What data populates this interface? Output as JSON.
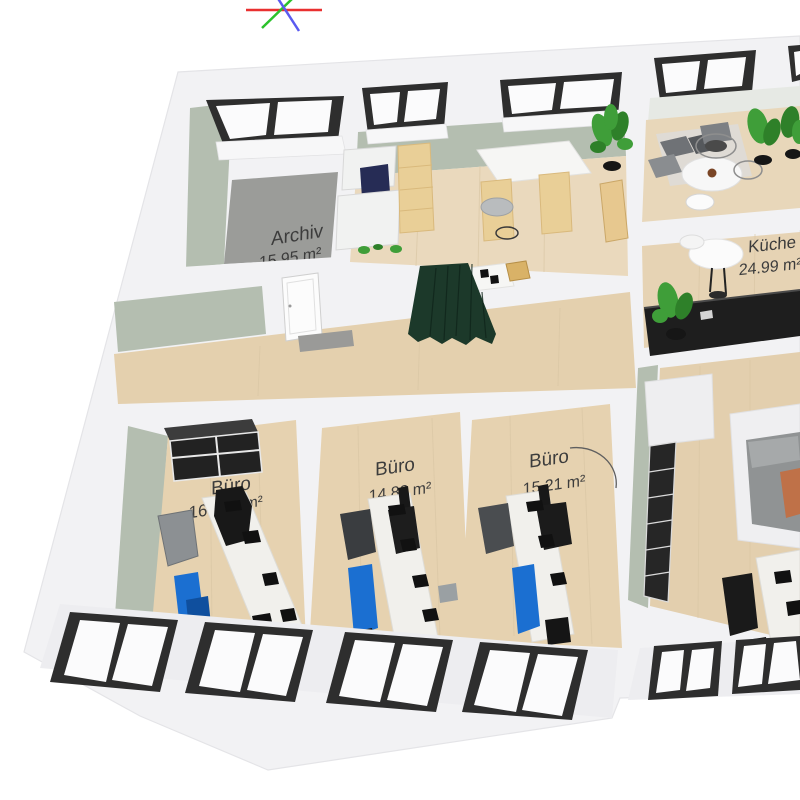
{
  "view": {
    "type": "3D floor plan viewport",
    "background": "#ffffff"
  },
  "axis_gizmo": {
    "axes": [
      {
        "name": "x",
        "color": "#e93030"
      },
      {
        "name": "y",
        "color": "#2cc22c"
      },
      {
        "name": "z",
        "color": "#5a5af0"
      }
    ]
  },
  "rooms": [
    {
      "id": "archiv",
      "name": "Archiv",
      "area": "15.95 m²"
    },
    {
      "id": "kueche",
      "name": "Küche",
      "area": "24.99 m²"
    },
    {
      "id": "buero_1",
      "name": "Büro",
      "area_value": "16",
      "area_unit": "m²"
    },
    {
      "id": "buero_2",
      "name": "Büro",
      "area": "14.82 m²"
    },
    {
      "id": "buero_3",
      "name": "Büro",
      "area": "15.21 m²"
    }
  ],
  "colors": {
    "outer_wall": "#f2f2f4",
    "interior_wall_green": "#b4beb0",
    "wood_floor": "#e6d2b0",
    "archive_floor": "#9b9c99",
    "window_frame": "#2e2e2e",
    "curtain_green": "#1c392a",
    "chair_blue": "#1b6fd1",
    "plant_green": "#3f9e39",
    "counter_black": "#1e1e1e",
    "label_text": "#3c3c3c"
  }
}
